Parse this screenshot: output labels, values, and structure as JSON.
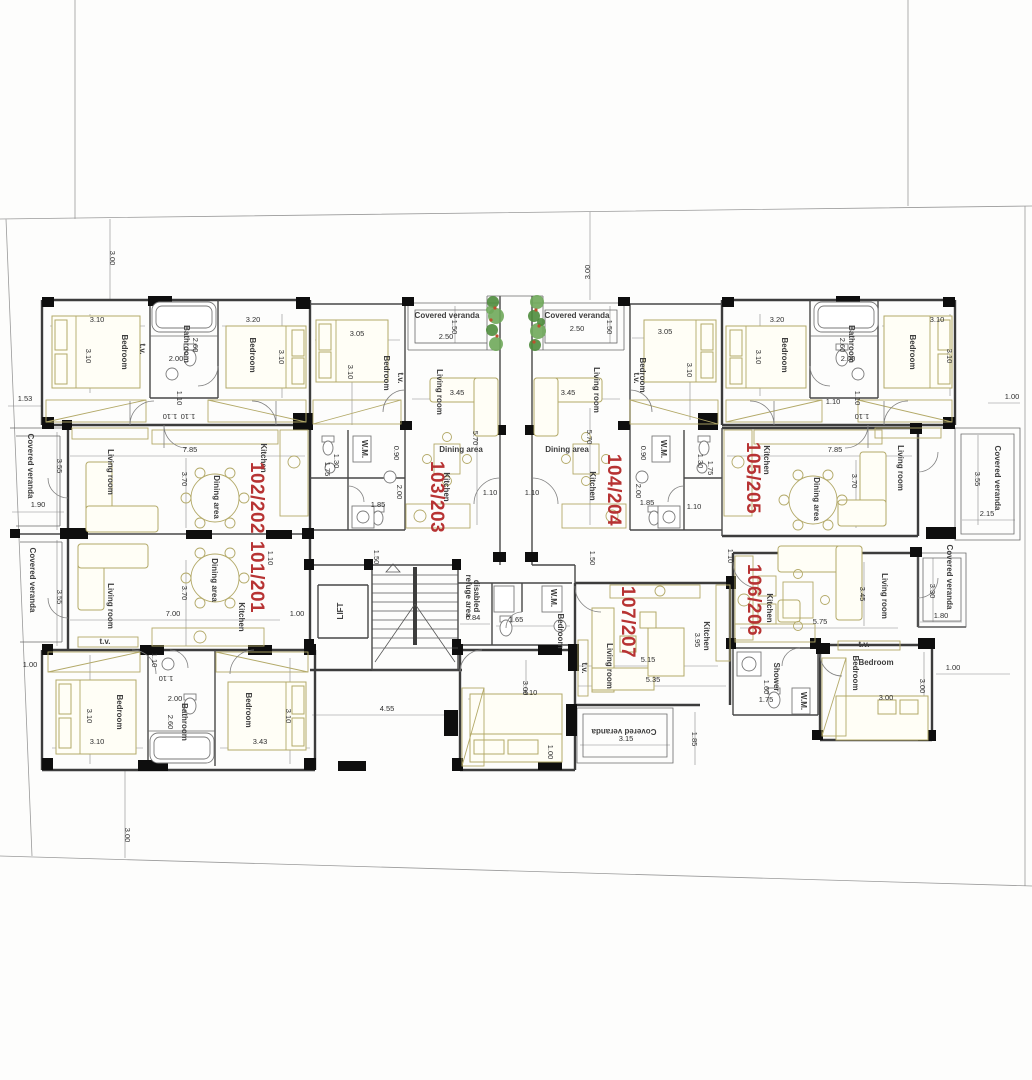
{
  "plan": {
    "colors": {
      "unit_label": "#b73333",
      "wall": "#3c3c3c",
      "column": "#0e0e0e",
      "furniture": "#b3a968",
      "plant_dark": "#4e8c3c",
      "plant_light": "#6fa85a",
      "plant_berry": "#bf4f2e",
      "dim_text": "#2f2f2f"
    },
    "units": [
      "101/201",
      "102/202",
      "103/203",
      "104/204",
      "105/205",
      "106/206",
      "107/207"
    ],
    "unit_labels": [
      {
        "t": "101/201",
        "x": 251,
        "y": 577,
        "r": 90
      },
      {
        "t": "102/202",
        "x": 251,
        "y": 498,
        "r": 90
      },
      {
        "t": "103/203",
        "x": 431,
        "y": 497,
        "r": 90
      },
      {
        "t": "104/204",
        "x": 608,
        "y": 490,
        "r": 90
      },
      {
        "t": "105/205",
        "x": 747,
        "y": 478,
        "r": 90
      },
      {
        "t": "106/206",
        "x": 748,
        "y": 600,
        "r": 90
      },
      {
        "t": "107/207",
        "x": 622,
        "y": 622,
        "r": 90
      }
    ],
    "room_labels": [
      {
        "t": "Bedroom",
        "x": 122,
        "y": 352,
        "r": 90
      },
      {
        "t": "Bathroom",
        "x": 184,
        "y": 344,
        "r": 90,
        "s": 6.5
      },
      {
        "t": "Bedroom",
        "x": 250,
        "y": 355,
        "r": 90
      },
      {
        "t": "Bedroom",
        "x": 782,
        "y": 355,
        "r": 90
      },
      {
        "t": "Bathroom",
        "x": 849,
        "y": 344,
        "r": 90,
        "s": 6.5
      },
      {
        "t": "Bedroom",
        "x": 910,
        "y": 352,
        "r": 90
      },
      {
        "t": "Covered veranda",
        "x": 447,
        "y": 318,
        "r": 0,
        "s": 9.5
      },
      {
        "t": "Covered veranda",
        "x": 577,
        "y": 318,
        "r": 0,
        "s": 9.5
      },
      {
        "t": "Bedroom",
        "x": 384,
        "y": 373,
        "r": 90
      },
      {
        "t": "Living room",
        "x": 437,
        "y": 392,
        "r": 90
      },
      {
        "t": "Dining area",
        "x": 461,
        "y": 452,
        "r": 0,
        "s": 6
      },
      {
        "t": "W.M.",
        "x": 362,
        "y": 449,
        "r": 90,
        "s": 5.5
      },
      {
        "t": "Kitchen",
        "x": 444,
        "y": 487,
        "r": 90
      },
      {
        "t": "Bedroom",
        "x": 640,
        "y": 375,
        "r": 90
      },
      {
        "t": "Living room",
        "x": 594,
        "y": 390,
        "r": 90
      },
      {
        "t": "Dining area",
        "x": 567,
        "y": 452,
        "r": 0,
        "s": 6
      },
      {
        "t": "W.M.",
        "x": 661,
        "y": 449,
        "r": 90,
        "s": 5.5
      },
      {
        "t": "Kitchen",
        "x": 590,
        "y": 486,
        "r": 90
      },
      {
        "t": "Covered veranda",
        "x": 28,
        "y": 466,
        "r": 90
      },
      {
        "t": "Living room",
        "x": 108,
        "y": 472,
        "r": 90
      },
      {
        "t": "Dining area",
        "x": 214,
        "y": 497,
        "r": 90
      },
      {
        "t": "Kitchen",
        "x": 261,
        "y": 458,
        "r": 90
      },
      {
        "t": "Covered veranda",
        "x": 30,
        "y": 580,
        "r": 90
      },
      {
        "t": "Living room",
        "x": 108,
        "y": 606,
        "r": 90
      },
      {
        "t": "Dining area",
        "x": 212,
        "y": 580,
        "r": 90
      },
      {
        "t": "Kitchen",
        "x": 239,
        "y": 617,
        "r": 90
      },
      {
        "t": "Kitchen",
        "x": 764,
        "y": 460,
        "r": 90
      },
      {
        "t": "Dining area",
        "x": 814,
        "y": 499,
        "r": 90
      },
      {
        "t": "Living room",
        "x": 898,
        "y": 468,
        "r": 90
      },
      {
        "t": "Covered veranda",
        "x": 995,
        "y": 478,
        "r": 90
      },
      {
        "t": "Covered veranda",
        "x": 947,
        "y": 577,
        "r": 90
      },
      {
        "t": "Kitchen",
        "x": 767,
        "y": 608,
        "r": 90
      },
      {
        "t": "Living room",
        "x": 882,
        "y": 596,
        "r": 90
      },
      {
        "t": "Bedroom",
        "x": 853,
        "y": 673,
        "r": 90,
        "s": 7
      },
      {
        "t": "Bedroom",
        "x": 876,
        "y": 665,
        "r": 0,
        "s": 7
      },
      {
        "t": "Living room",
        "x": 607,
        "y": 666,
        "r": 90
      },
      {
        "t": "Kitchen",
        "x": 704,
        "y": 636,
        "r": 90
      },
      {
        "t": "Bedroom",
        "x": 558,
        "y": 631,
        "r": 90,
        "s": 7
      },
      {
        "t": "Covered veranda",
        "x": 624,
        "y": 729,
        "r": 180,
        "s": 9
      },
      {
        "t": "Bedroom",
        "x": 117,
        "y": 712,
        "r": 90
      },
      {
        "t": "Bathroom",
        "x": 182,
        "y": 722,
        "r": 90,
        "s": 6.5
      },
      {
        "t": "Bedroom",
        "x": 246,
        "y": 710,
        "r": 90
      },
      {
        "t": "LIFT",
        "x": 343,
        "y": 611,
        "r": -90,
        "s": 7.5
      },
      {
        "t": "refuge area",
        "x": 466,
        "y": 596,
        "r": 90,
        "s": 5.5
      },
      {
        "t": "disabled",
        "x": 474,
        "y": 596,
        "r": 90,
        "s": 5.5
      },
      {
        "t": "W.M.",
        "x": 551,
        "y": 598,
        "r": 90,
        "s": 5.5
      },
      {
        "t": "Shower",
        "x": 774,
        "y": 677,
        "r": 90,
        "s": 5.5
      },
      {
        "t": "W.M.",
        "x": 801,
        "y": 701,
        "r": 90,
        "s": 5.5
      },
      {
        "t": "t.v.",
        "x": 140,
        "y": 349,
        "r": 90,
        "s": 5
      },
      {
        "t": "t.v.",
        "x": 398,
        "y": 378,
        "r": 90,
        "s": 5
      },
      {
        "t": "t.v.",
        "x": 634,
        "y": 378,
        "r": 90,
        "s": 5
      },
      {
        "t": "t.v.",
        "x": 582,
        "y": 668,
        "r": 90,
        "s": 5
      },
      {
        "t": "t.v.",
        "x": 105,
        "y": 644,
        "r": 0,
        "s": 5
      },
      {
        "t": "t.v.",
        "x": 864,
        "y": 647,
        "r": 0,
        "s": 5
      }
    ],
    "dim_labels": [
      {
        "t": "3.00",
        "x": 110,
        "y": 258,
        "r": 90
      },
      {
        "t": "3.00",
        "x": 590,
        "y": 272,
        "r": -90
      },
      {
        "t": "3.00",
        "x": 125,
        "y": 835,
        "r": 90
      },
      {
        "t": "1.53",
        "x": 25,
        "y": 401,
        "r": 0
      },
      {
        "t": "1.00",
        "x": 1012,
        "y": 399,
        "r": 0
      },
      {
        "t": "1.00",
        "x": 30,
        "y": 667,
        "r": 0
      },
      {
        "t": "1.00",
        "x": 953,
        "y": 670,
        "r": 0
      },
      {
        "t": "3.10",
        "x": 97,
        "y": 322,
        "r": 0
      },
      {
        "t": "3.10",
        "x": 86,
        "y": 356,
        "r": 90
      },
      {
        "t": "3.20",
        "x": 253,
        "y": 322,
        "r": 0
      },
      {
        "t": "3.10",
        "x": 279,
        "y": 357,
        "r": 90
      },
      {
        "t": "2.60",
        "x": 193,
        "y": 345,
        "r": 90
      },
      {
        "t": "2.00",
        "x": 176,
        "y": 361,
        "r": 0
      },
      {
        "t": "1.10",
        "x": 177,
        "y": 398,
        "r": 90
      },
      {
        "t": "1.10",
        "x": 170,
        "y": 414,
        "r": 180
      },
      {
        "t": "3.20",
        "x": 777,
        "y": 322,
        "r": 0
      },
      {
        "t": "3.10",
        "x": 937,
        "y": 322,
        "r": 0
      },
      {
        "t": "3.10",
        "x": 756,
        "y": 357,
        "r": 90
      },
      {
        "t": "3.10",
        "x": 947,
        "y": 356,
        "r": 90
      },
      {
        "t": "2.60",
        "x": 840,
        "y": 345,
        "r": 90
      },
      {
        "t": "2.00",
        "x": 848,
        "y": 361,
        "r": 0
      },
      {
        "t": "1.10",
        "x": 855,
        "y": 398,
        "r": 90
      },
      {
        "t": "1.10",
        "x": 862,
        "y": 414,
        "r": 180
      },
      {
        "t": "1.50",
        "x": 452,
        "y": 327,
        "r": 90
      },
      {
        "t": "2.50",
        "x": 446,
        "y": 339,
        "r": 0
      },
      {
        "t": "1.50",
        "x": 607,
        "y": 327,
        "r": 90
      },
      {
        "t": "2.50",
        "x": 577,
        "y": 331,
        "r": 0
      },
      {
        "t": "3.05",
        "x": 357,
        "y": 336,
        "r": 0
      },
      {
        "t": "3.10",
        "x": 348,
        "y": 372,
        "r": 90
      },
      {
        "t": "3.45",
        "x": 457,
        "y": 395,
        "r": 0
      },
      {
        "t": "5.70",
        "x": 473,
        "y": 438,
        "r": 90
      },
      {
        "t": "0.90",
        "x": 394,
        "y": 453,
        "r": 90
      },
      {
        "t": "2.00",
        "x": 397,
        "y": 492,
        "r": 90
      },
      {
        "t": "1.85",
        "x": 378,
        "y": 507,
        "r": 0
      },
      {
        "t": "1.10",
        "x": 490,
        "y": 495,
        "r": 0
      },
      {
        "t": "1.10",
        "x": 532,
        "y": 495,
        "r": 0
      },
      {
        "t": "1.50",
        "x": 374,
        "y": 557,
        "r": 90
      },
      {
        "t": "1.30",
        "x": 334,
        "y": 461,
        "r": 90
      },
      {
        "t": "1.75",
        "x": 325,
        "y": 469,
        "r": 90
      },
      {
        "t": "3.05",
        "x": 665,
        "y": 334,
        "r": 0
      },
      {
        "t": "3.10",
        "x": 687,
        "y": 370,
        "r": 90
      },
      {
        "t": "3.45",
        "x": 568,
        "y": 395,
        "r": 0
      },
      {
        "t": "5.70",
        "x": 587,
        "y": 437,
        "r": 90
      },
      {
        "t": "0.90",
        "x": 641,
        "y": 453,
        "r": 90
      },
      {
        "t": "2.00",
        "x": 636,
        "y": 491,
        "r": 90
      },
      {
        "t": "1.85",
        "x": 647,
        "y": 505,
        "r": 0
      },
      {
        "t": "1.30",
        "x": 698,
        "y": 461,
        "r": 90
      },
      {
        "t": "1.75",
        "x": 708,
        "y": 468,
        "r": 90
      },
      {
        "t": "1.10",
        "x": 694,
        "y": 509,
        "r": 0
      },
      {
        "t": "1.50",
        "x": 590,
        "y": 558,
        "r": 90
      },
      {
        "t": "3.55",
        "x": 57,
        "y": 466,
        "r": 90
      },
      {
        "t": "1.90",
        "x": 38,
        "y": 507,
        "r": 0
      },
      {
        "t": "7.85",
        "x": 190,
        "y": 452,
        "r": 0
      },
      {
        "t": "3.70",
        "x": 182,
        "y": 479,
        "r": 90
      },
      {
        "t": "1.10",
        "x": 188,
        "y": 414,
        "r": 180
      },
      {
        "t": "7.85",
        "x": 835,
        "y": 452,
        "r": 0
      },
      {
        "t": "3.70",
        "x": 852,
        "y": 481,
        "r": 90
      },
      {
        "t": "1.10",
        "x": 833,
        "y": 404,
        "r": 0
      },
      {
        "t": "3.55",
        "x": 975,
        "y": 479,
        "r": 90
      },
      {
        "t": "2.15",
        "x": 987,
        "y": 516,
        "r": 0
      },
      {
        "t": "3.55",
        "x": 57,
        "y": 597,
        "r": 90
      },
      {
        "t": "7.00",
        "x": 173,
        "y": 616,
        "r": 0
      },
      {
        "t": "3.70",
        "x": 182,
        "y": 593,
        "r": 90
      },
      {
        "t": "1.10",
        "x": 268,
        "y": 558,
        "r": 90
      },
      {
        "t": "1.00",
        "x": 297,
        "y": 616,
        "r": 0
      },
      {
        "t": "1.10",
        "x": 152,
        "y": 660,
        "r": 90
      },
      {
        "t": "1.10",
        "x": 166,
        "y": 676,
        "r": 180
      },
      {
        "t": "3.10",
        "x": 87,
        "y": 716,
        "r": 90
      },
      {
        "t": "3.10",
        "x": 97,
        "y": 744,
        "r": 0
      },
      {
        "t": "2.00",
        "x": 175,
        "y": 701,
        "r": 0
      },
      {
        "t": "2.60",
        "x": 168,
        "y": 722,
        "r": 90
      },
      {
        "t": "3.43",
        "x": 260,
        "y": 744,
        "r": 0
      },
      {
        "t": "3.10",
        "x": 286,
        "y": 716,
        "r": 90
      },
      {
        "t": "4.55",
        "x": 387,
        "y": 711,
        "r": 0
      },
      {
        "t": "0.84",
        "x": 473,
        "y": 620,
        "r": 0
      },
      {
        "t": "1.65",
        "x": 516,
        "y": 622,
        "r": 0
      },
      {
        "t": "5.15",
        "x": 648,
        "y": 662,
        "r": 0
      },
      {
        "t": "5.35",
        "x": 653,
        "y": 682,
        "r": 0
      },
      {
        "t": "3.95",
        "x": 695,
        "y": 640,
        "r": 90
      },
      {
        "t": "3.00",
        "x": 523,
        "y": 688,
        "r": 90
      },
      {
        "t": "3.10",
        "x": 530,
        "y": 695,
        "r": 0
      },
      {
        "t": "1.00",
        "x": 548,
        "y": 752,
        "r": 90
      },
      {
        "t": "3.15",
        "x": 626,
        "y": 741,
        "r": 0
      },
      {
        "t": "1.85",
        "x": 692,
        "y": 739,
        "r": 90
      },
      {
        "t": "1.10",
        "x": 728,
        "y": 556,
        "r": 90
      },
      {
        "t": "5.75",
        "x": 820,
        "y": 624,
        "r": 0
      },
      {
        "t": "3.45",
        "x": 860,
        "y": 594,
        "r": 90
      },
      {
        "t": "3.30",
        "x": 930,
        "y": 591,
        "r": 90
      },
      {
        "t": "1.80",
        "x": 941,
        "y": 618,
        "r": 0
      },
      {
        "t": "1.60",
        "x": 764,
        "y": 687,
        "r": 90
      },
      {
        "t": "1.75",
        "x": 766,
        "y": 702,
        "r": 0
      },
      {
        "t": "3.00",
        "x": 886,
        "y": 700,
        "r": 0
      },
      {
        "t": "3.00",
        "x": 920,
        "y": 686,
        "r": 90
      }
    ]
  }
}
